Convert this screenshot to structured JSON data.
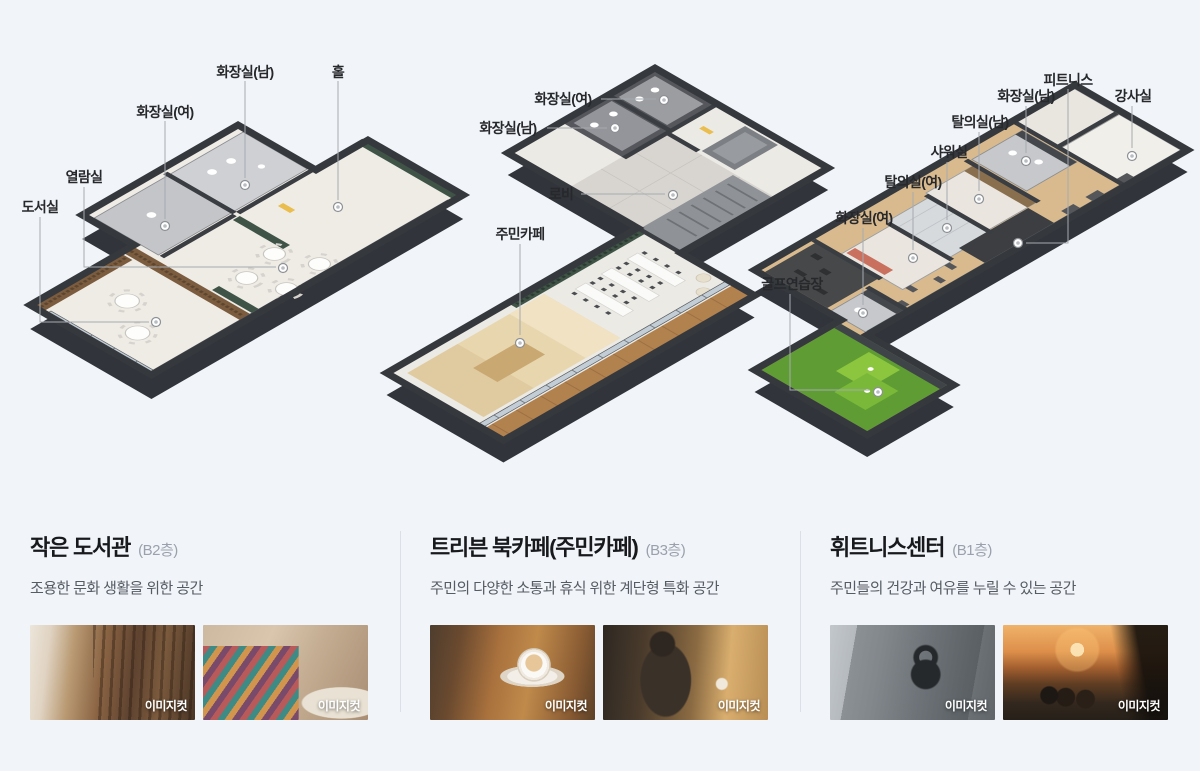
{
  "page": {
    "background": "#f1f4f9"
  },
  "plans": [
    {
      "name": "작은 도서관 평면도",
      "labels": [
        "도서실",
        "열람실",
        "화장실(여)",
        "화장실(남)",
        "홀"
      ]
    },
    {
      "name": "트리븐 북카페 평면도",
      "labels": [
        "화장실(여)",
        "화장실(남)",
        "로비",
        "주민카페"
      ]
    },
    {
      "name": "휘트니스센터 평면도",
      "labels": [
        "피트니스",
        "화장실(남)",
        "강사실",
        "탈의실(남)",
        "샤워실",
        "탈의실(여)",
        "화장실(여)",
        "골프연습장"
      ]
    }
  ],
  "sections": [
    {
      "title": "작은 도서관",
      "floor": "(B2층)",
      "desc": "조용한 문화 생활을 위한 공간",
      "photos": [
        {
          "badge": "이미지컷"
        },
        {
          "badge": "이미지컷"
        }
      ]
    },
    {
      "title": "트리븐 북카페(주민카페)",
      "floor": "(B3층)",
      "desc": "주민의 다양한 소통과 휴식 위한 계단형 특화 공간",
      "photos": [
        {
          "badge": "이미지컷"
        },
        {
          "badge": "이미지컷"
        }
      ]
    },
    {
      "title": "휘트니스센터",
      "floor": "(B1층)",
      "desc": "주민들의 건강과 여유를 누릴 수 있는 공간",
      "photos": [
        {
          "badge": "이미지컷"
        },
        {
          "badge": "이미지컷"
        }
      ]
    }
  ]
}
